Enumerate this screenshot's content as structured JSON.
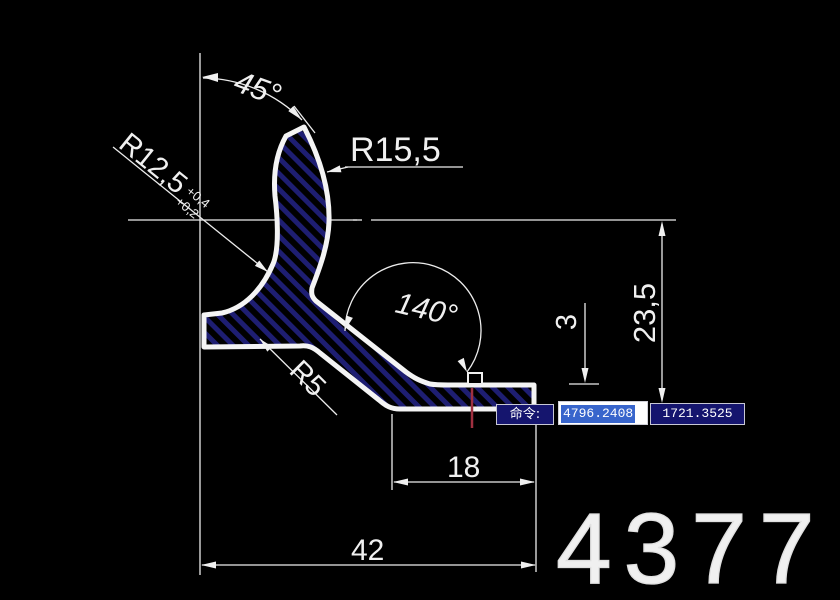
{
  "drawing": {
    "part_number": "4377",
    "dims": {
      "angle_top": "45°",
      "r_inner": "R12,5",
      "r_inner_tol_up": "+0,4",
      "r_inner_tol_low": "+0,2",
      "r_outer": "R15,5",
      "angle_bend": "140°",
      "thickness": "3",
      "height": "23,5",
      "r_fillet": "R5",
      "len_step": "18",
      "len_total": "42"
    },
    "colors": {
      "background": "#000000",
      "line": "#f0f0f0",
      "hatch": "#1e1e72",
      "marker_red": "#a03040"
    }
  },
  "command_bar": {
    "prompt_label": "命令:",
    "coord_x": "4796.2408",
    "coord_y": "1721.3525",
    "colors": {
      "panel_bg": "#15156e",
      "panel_border": "#c8c8d4",
      "selection_bg": "#3865cc",
      "field_bg": "#ffffff",
      "text": "#ffffff"
    }
  }
}
